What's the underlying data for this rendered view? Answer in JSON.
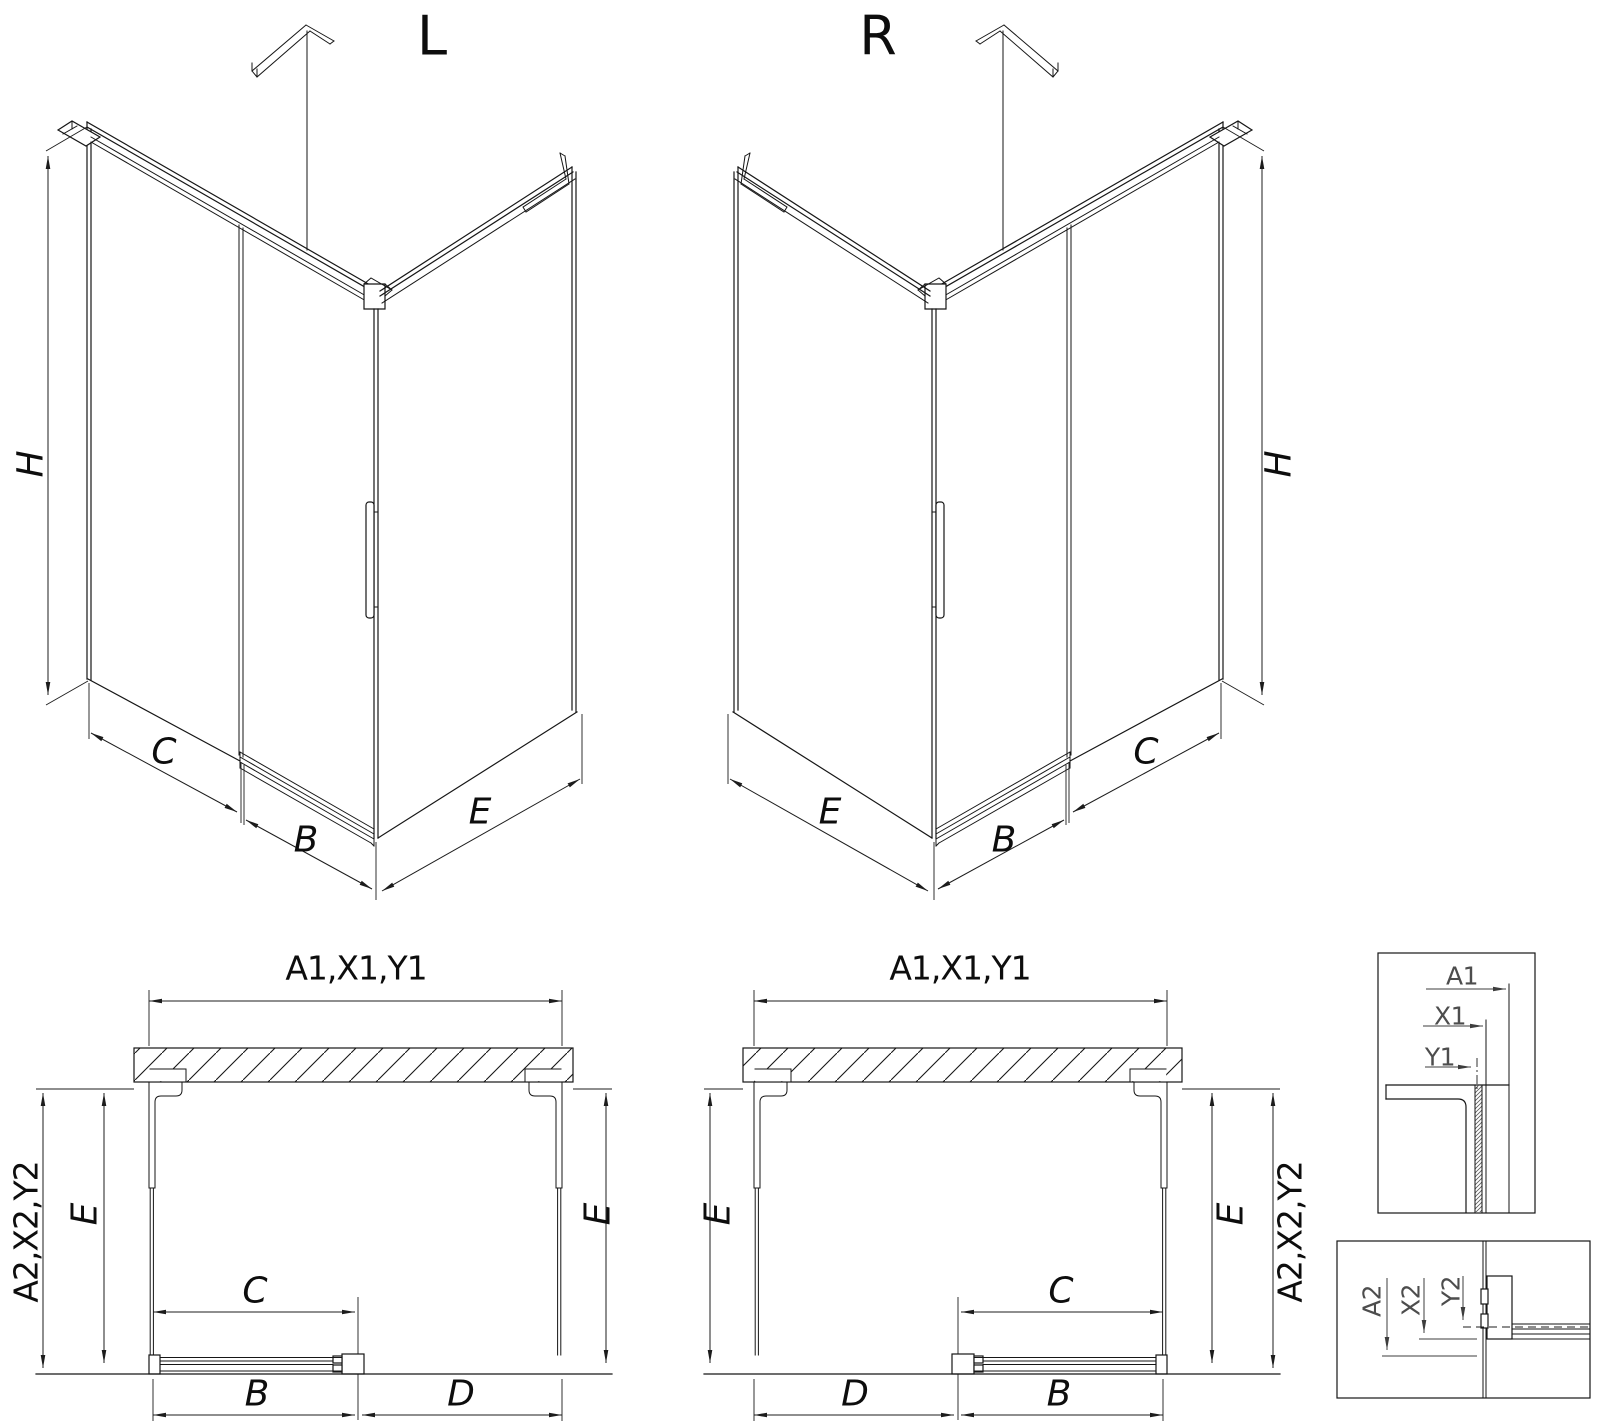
{
  "document": {
    "type": "technical-drawing",
    "subject": "corner sliding-door shower enclosure dimension diagram",
    "background_color": "#ffffff",
    "line_color": "#161616",
    "detail_label_color": "#4d4d4d"
  },
  "views": {
    "iso_left": {
      "variant_label": "L",
      "dimension_labels": [
        "H",
        "C",
        "B",
        "E"
      ]
    },
    "iso_right": {
      "variant_label": "R",
      "dimension_labels": [
        "E",
        "B",
        "C",
        "H"
      ]
    },
    "plan_left": {
      "top_label": "A1,X1,Y1",
      "left_outer_label": "A2,X2,Y2",
      "side_labels": [
        "E",
        "E"
      ],
      "bottom_labels": [
        "C",
        "B",
        "D"
      ]
    },
    "plan_right": {
      "top_label": "A1,X1,Y1",
      "right_outer_label": "A2,X2,Y2",
      "side_labels": [
        "E",
        "E"
      ],
      "bottom_labels": [
        "C",
        "D",
        "B"
      ]
    },
    "detail_top_profile": {
      "labels": [
        "A1",
        "X1",
        "Y1"
      ]
    },
    "detail_bottom_profile": {
      "labels": [
        "A2",
        "X2",
        "Y2"
      ]
    }
  },
  "annotations": [
    {
      "name": "iso-left-title",
      "text": "L",
      "x": 432,
      "y": 36,
      "rot": 0,
      "cls": "t-big"
    },
    {
      "name": "iso-right-title",
      "text": "R",
      "x": 878,
      "y": 36,
      "rot": 0,
      "cls": "t-big"
    },
    {
      "name": "iso-left-dim-h",
      "text": "H",
      "x": 31,
      "y": 464,
      "rot": -90,
      "cls": "t-dim"
    },
    {
      "name": "iso-left-dim-c",
      "text": "C",
      "x": 164,
      "y": 752,
      "rot": 0,
      "cls": "t-dim"
    },
    {
      "name": "iso-left-dim-b",
      "text": "B",
      "x": 306,
      "y": 840,
      "rot": 0,
      "cls": "t-dim"
    },
    {
      "name": "iso-left-dim-e",
      "text": "E",
      "x": 480,
      "y": 812,
      "rot": 0,
      "cls": "t-dim"
    },
    {
      "name": "iso-right-dim-e",
      "text": "E",
      "x": 830,
      "y": 812,
      "rot": 0,
      "cls": "t-dim"
    },
    {
      "name": "iso-right-dim-b",
      "text": "B",
      "x": 1004,
      "y": 840,
      "rot": 0,
      "cls": "t-dim"
    },
    {
      "name": "iso-right-dim-c",
      "text": "C",
      "x": 1146,
      "y": 752,
      "rot": 0,
      "cls": "t-dim"
    },
    {
      "name": "iso-right-dim-h",
      "text": "H",
      "x": 1279,
      "y": 464,
      "rot": -90,
      "cls": "t-dim"
    },
    {
      "name": "plan-left-dim-top",
      "text": "A1,X1,Y1",
      "x": 356,
      "y": 968,
      "rot": 0,
      "cls": "t-plan"
    },
    {
      "name": "plan-left-dim-outer",
      "text": "A2,X2,Y2",
      "x": 26,
      "y": 1232,
      "rot": -90,
      "cls": "t-plan"
    },
    {
      "name": "plan-left-dim-e-left",
      "text": "E",
      "x": 85,
      "y": 1214,
      "rot": -90,
      "cls": "t-dim"
    },
    {
      "name": "plan-left-dim-e-right",
      "text": "E",
      "x": 598,
      "y": 1214,
      "rot": -90,
      "cls": "t-dim"
    },
    {
      "name": "plan-left-dim-c",
      "text": "C",
      "x": 255,
      "y": 1291,
      "rot": 0,
      "cls": "t-dim"
    },
    {
      "name": "plan-left-dim-b",
      "text": "B",
      "x": 257,
      "y": 1394,
      "rot": 0,
      "cls": "t-dim"
    },
    {
      "name": "plan-left-dim-d",
      "text": "D",
      "x": 461,
      "y": 1394,
      "rot": 0,
      "cls": "t-dim"
    },
    {
      "name": "plan-right-dim-top",
      "text": "A1,X1,Y1",
      "x": 960,
      "y": 968,
      "rot": 0,
      "cls": "t-plan"
    },
    {
      "name": "plan-right-dim-e-left",
      "text": "E",
      "x": 718,
      "y": 1214,
      "rot": -90,
      "cls": "t-dim"
    },
    {
      "name": "plan-right-dim-e-right",
      "text": "E",
      "x": 1231,
      "y": 1214,
      "rot": -90,
      "cls": "t-dim"
    },
    {
      "name": "plan-right-dim-outer",
      "text": "A2,X2,Y2",
      "x": 1290,
      "y": 1232,
      "rot": -90,
      "cls": "t-plan"
    },
    {
      "name": "plan-right-dim-c",
      "text": "C",
      "x": 1061,
      "y": 1291,
      "rot": 0,
      "cls": "t-dim"
    },
    {
      "name": "plan-right-dim-d",
      "text": "D",
      "x": 855,
      "y": 1394,
      "rot": 0,
      "cls": "t-dim"
    },
    {
      "name": "plan-right-dim-b",
      "text": "B",
      "x": 1059,
      "y": 1394,
      "rot": 0,
      "cls": "t-dim"
    },
    {
      "name": "detail-top-dim-a1",
      "text": "A1",
      "x": 1462,
      "y": 976,
      "rot": 0,
      "cls": "t-det"
    },
    {
      "name": "detail-top-dim-x1",
      "text": "X1",
      "x": 1450,
      "y": 1016,
      "rot": 0,
      "cls": "t-det"
    },
    {
      "name": "detail-top-dim-y1",
      "text": "Y1",
      "x": 1440,
      "y": 1057,
      "rot": 0,
      "cls": "t-det"
    },
    {
      "name": "detail-bottom-dim-a2",
      "text": "A2",
      "x": 1372,
      "y": 1301,
      "rot": -90,
      "cls": "t-det"
    },
    {
      "name": "detail-bottom-dim-x2",
      "text": "X2",
      "x": 1411,
      "y": 1300,
      "rot": -90,
      "cls": "t-det"
    },
    {
      "name": "detail-bottom-dim-y2",
      "text": "Y2",
      "x": 1451,
      "y": 1291,
      "rot": -90,
      "cls": "t-det"
    }
  ]
}
